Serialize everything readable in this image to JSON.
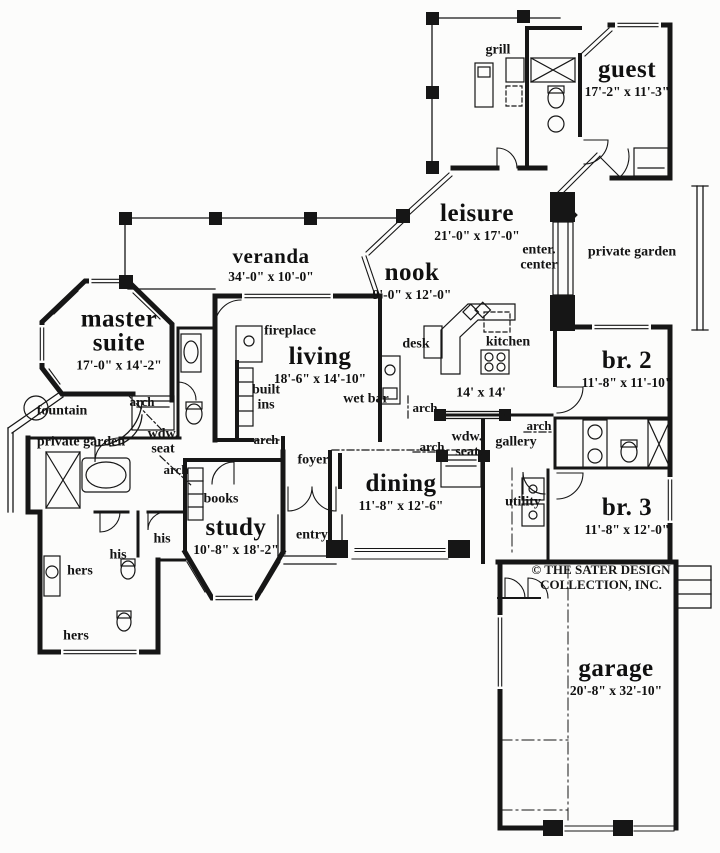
{
  "plan_title": "floor plan",
  "rooms": [
    {
      "id": "master-suite",
      "name": "master suite",
      "dims": "17'-0\" x 14'-2\""
    },
    {
      "id": "veranda",
      "name": "veranda",
      "dims": "34'-0\" x 10'-0\""
    },
    {
      "id": "living",
      "name": "living",
      "dims": "18'-6\" x 14'-10\""
    },
    {
      "id": "nook",
      "name": "nook",
      "dims": "9'-0\" x 12'-0\""
    },
    {
      "id": "leisure",
      "name": "leisure",
      "dims": "21'-0\" x 17'-0\""
    },
    {
      "id": "guest",
      "name": "guest",
      "dims": "17'-2\" x 11'-3\""
    },
    {
      "id": "br-2",
      "name": "br. 2",
      "dims": "11'-8\" x 11'-10\""
    },
    {
      "id": "br-3",
      "name": "br. 3",
      "dims": "11'-8\" x 12'-0\""
    },
    {
      "id": "dining",
      "name": "dining",
      "dims": "11'-8\" x 12'-6\""
    },
    {
      "id": "study",
      "name": "study",
      "dims": "10'-8\" x 18'-2\""
    },
    {
      "id": "garage",
      "name": "garage",
      "dims": "20'-8\" x 32'-10\""
    }
  ],
  "features": [
    {
      "id": "grill",
      "label": "grill"
    },
    {
      "id": "enter-center",
      "label": "enter. center"
    },
    {
      "id": "private-garden-right",
      "label": "private garden"
    },
    {
      "id": "private-garden-left",
      "label": "private garden"
    },
    {
      "id": "fireplace",
      "label": "fireplace"
    },
    {
      "id": "built-ins",
      "label": "built ins"
    },
    {
      "id": "desk",
      "label": "desk"
    },
    {
      "id": "wet-bar",
      "label": "wet bar"
    },
    {
      "id": "fountain",
      "label": "fountain"
    },
    {
      "id": "wdw-seat-left",
      "label": "wdw. seat"
    },
    {
      "id": "wdw-seat-right",
      "label": "wdw. seat"
    },
    {
      "id": "gallery",
      "label": "gallery"
    },
    {
      "id": "foyer",
      "label": "foyer"
    },
    {
      "id": "entry",
      "label": "entry"
    },
    {
      "id": "books",
      "label": "books"
    },
    {
      "id": "utility",
      "label": "utility"
    },
    {
      "id": "his-1",
      "label": "his"
    },
    {
      "id": "his-2",
      "label": "his"
    },
    {
      "id": "hers-1",
      "label": "hers"
    },
    {
      "id": "hers-2",
      "label": "hers"
    },
    {
      "id": "kitchen",
      "label": "kitchen"
    },
    {
      "id": "kitchen-dims",
      "label": "14' x 14'"
    },
    {
      "id": "arch-1",
      "label": "arch"
    },
    {
      "id": "arch-2",
      "label": "arch"
    },
    {
      "id": "arch-3",
      "label": "arch"
    },
    {
      "id": "arch-4",
      "label": "arch"
    },
    {
      "id": "arch-5",
      "label": "arch"
    },
    {
      "id": "arch-6",
      "label": "arch"
    }
  ],
  "copyright": {
    "line1": "© THE SATER DESIGN",
    "line2": "COLLECTION, INC."
  }
}
